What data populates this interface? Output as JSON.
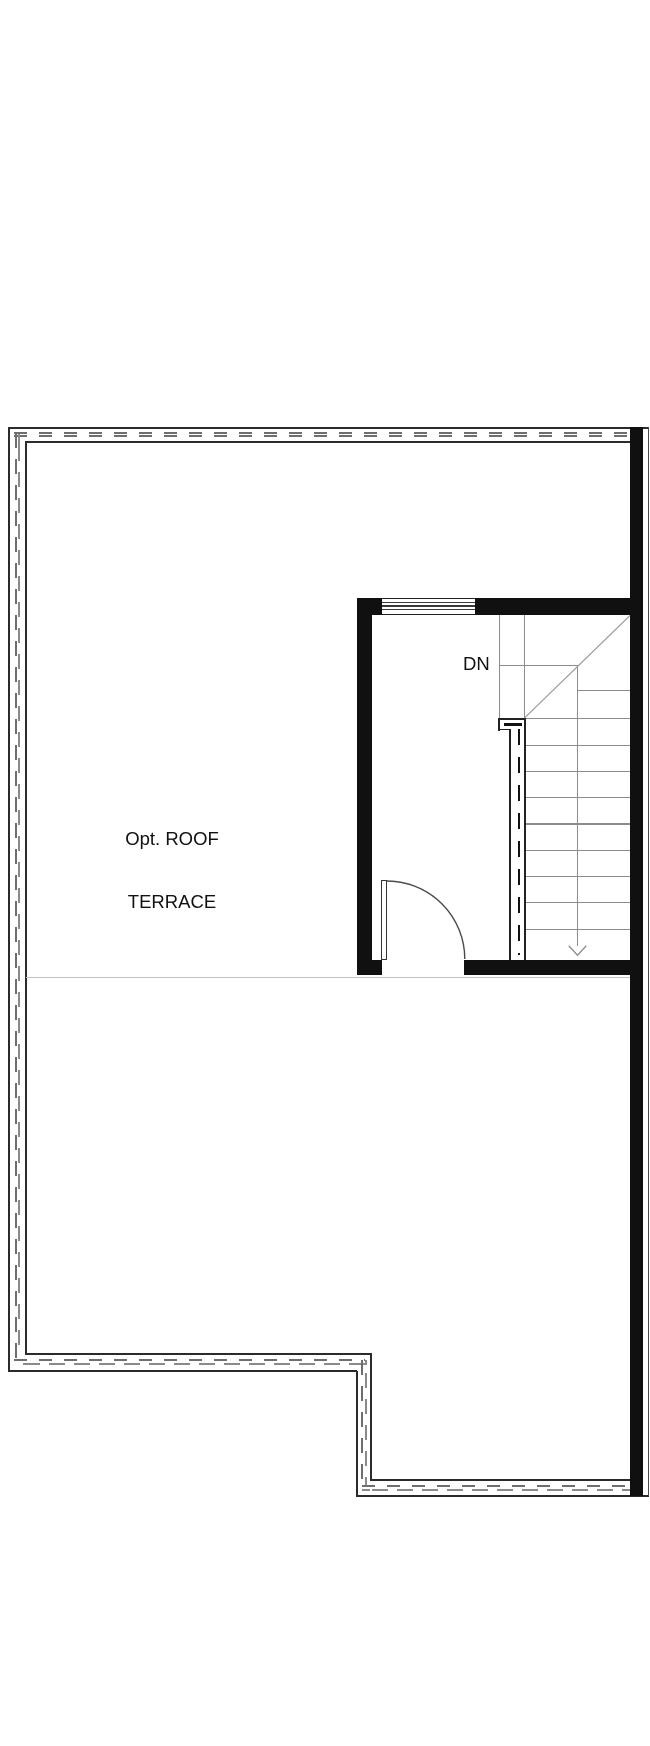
{
  "plan": {
    "room_label_line1": "Opt. ROOF",
    "room_label_line2": "TERRACE",
    "stair_direction_label": "DN"
  },
  "colors": {
    "bg": "#ffffff",
    "wall": "#101010",
    "border": "#2b2b2b",
    "dash": "#6e6e6e",
    "stair": "#8c8c8c",
    "rail": "#222222",
    "door": "#4a4a4a"
  }
}
